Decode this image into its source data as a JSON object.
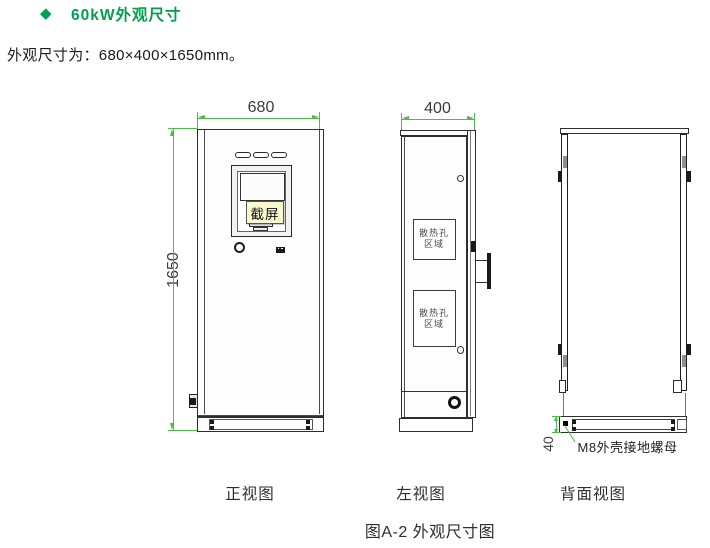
{
  "header": {
    "bullet_icon": "◆",
    "title": "60kW外观尺寸",
    "subtitle": "外观尺寸为：680×400×1650mm。"
  },
  "dimensions": {
    "front_width": "680",
    "front_height": "1650",
    "side_depth": "400",
    "base_height": "40"
  },
  "labels": {
    "vent_area_line1": "散热孔",
    "vent_area_line2": "区域",
    "ground_nut": "M8外壳接地螺母",
    "screenshot_tooltip": "截屏"
  },
  "captions": {
    "front_view": "正视图",
    "left_view": "左视图",
    "back_view": "背面视图",
    "figure": "图A-2 外观尺寸图"
  },
  "colors": {
    "title_green": "#00A050",
    "dimension_green": "#4CBB49",
    "line_dark": "#2E2E2E",
    "tooltip_bg": "#F8F8CF"
  }
}
